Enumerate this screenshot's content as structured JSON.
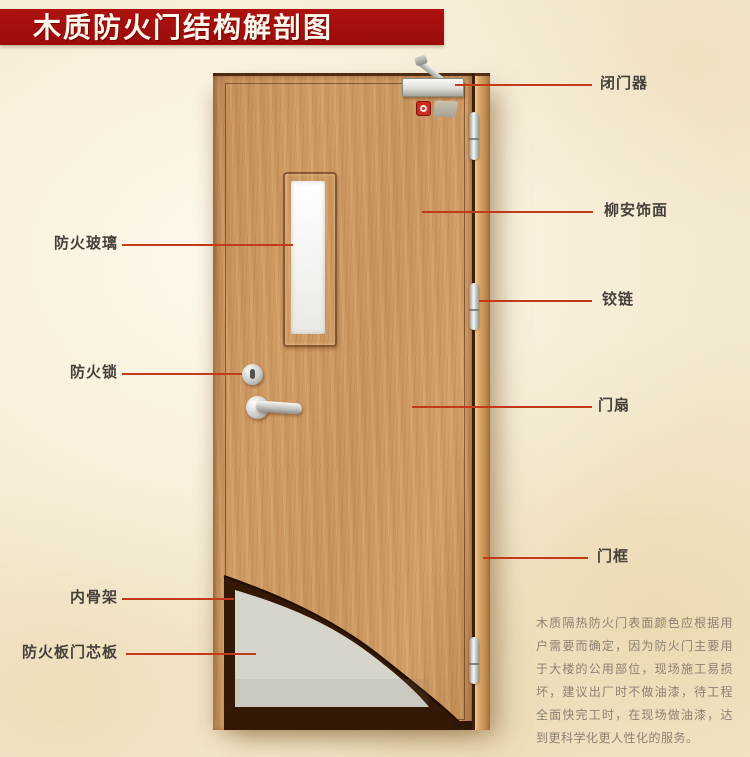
{
  "title": "木质防火门结构解剖图",
  "callouts": {
    "left": [
      {
        "label": "防火玻璃"
      },
      {
        "label": "防火锁"
      },
      {
        "label": "内骨架"
      },
      {
        "label": "防火板门芯板"
      }
    ],
    "right": [
      {
        "label": "闭门器"
      },
      {
        "label": "柳安饰面"
      },
      {
        "label": "铰链"
      },
      {
        "label": "门扇"
      },
      {
        "label": "门框"
      }
    ]
  },
  "note": "木质隔热防火门表面颜色应根据用户需要而确定，因为防火门主要用于大楼的公用部位，现场施工易损坏，建议出厂时不做油漆，待工程全面快完工时，在现场做油漆，达到更科学化更人性化的服务。",
  "colors": {
    "banner_red": "#9c0b0c",
    "callout_line": "#c23a1a",
    "label_text": "#46413a",
    "note_text": "#8d8171",
    "door_wood": "#cf9a63",
    "core_board_gray": "#d6d5cc",
    "inner_skeleton_brown": "#331806"
  }
}
